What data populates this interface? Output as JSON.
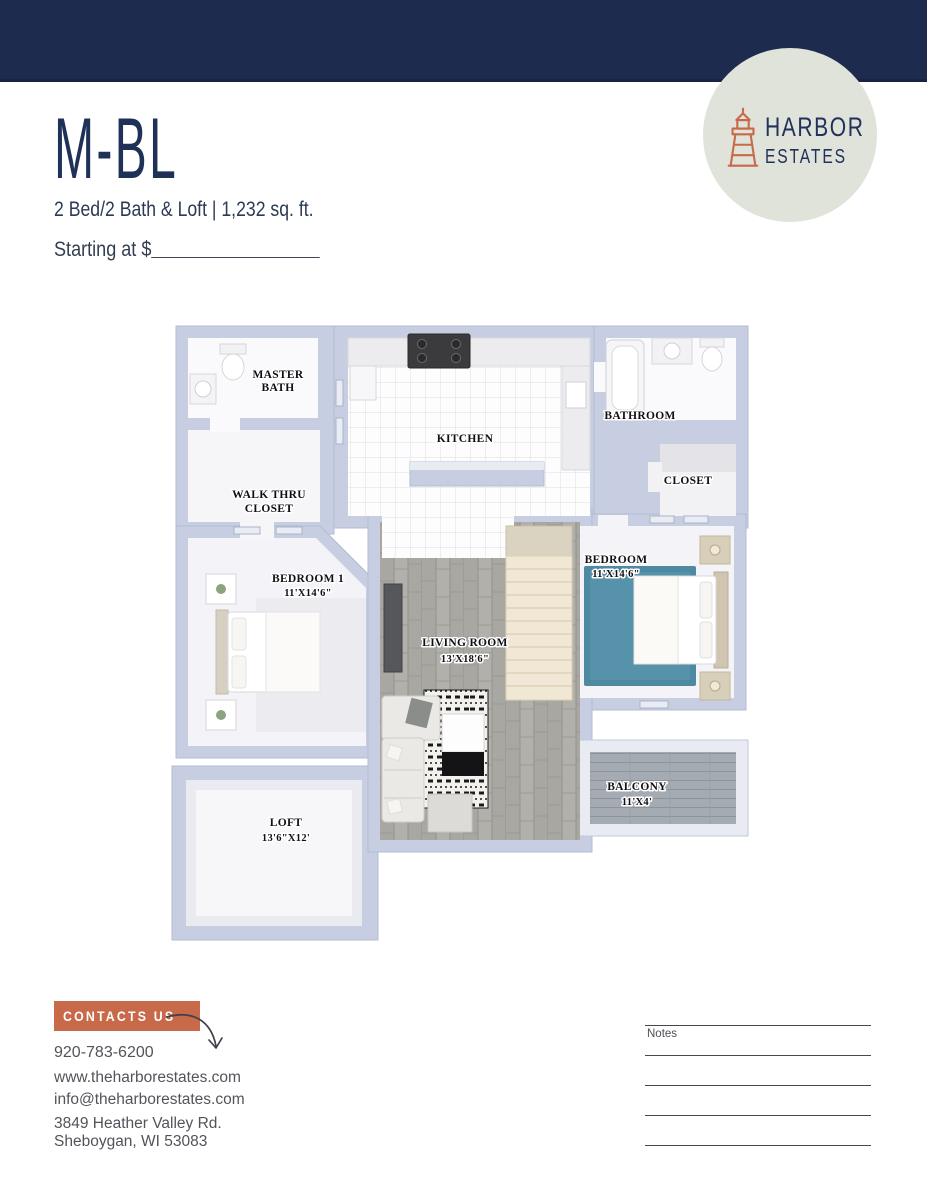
{
  "colors": {
    "header_navy": "#1d2b4e",
    "brand_navy": "#1f3156",
    "accent_orange": "#c8694a",
    "logo_circle_sage": "#dfe3da",
    "wall_gray_blue": "#c7cee1",
    "bedroom_rug_teal": "#4d89a1"
  },
  "logo": {
    "icon": "lighthouse-icon",
    "name_line1": "HARBOR",
    "name_line2": "ESTATES"
  },
  "plan": {
    "title": "M-BL",
    "subtitle": "2 Bed/2 Bath & Loft | 1,232 sq. ft.",
    "starting_at_label": "Starting at $"
  },
  "floorplan": {
    "rooms": [
      {
        "id": "master-bath",
        "line1": "MASTER",
        "line2": "BATH"
      },
      {
        "id": "walk-thru-closet",
        "line1": "WALK THRU",
        "line2": "CLOSET"
      },
      {
        "id": "bedroom-1",
        "line1": "BEDROOM 1",
        "line2": "11'X14'6\""
      },
      {
        "id": "kitchen",
        "line1": "KITCHEN",
        "line2": ""
      },
      {
        "id": "bathroom",
        "line1": "BATHROOM",
        "line2": ""
      },
      {
        "id": "closet",
        "line1": "CLOSET",
        "line2": ""
      },
      {
        "id": "bedroom-2",
        "line1": "BEDROOM",
        "line2": "11'X14'6\""
      },
      {
        "id": "living-room",
        "line1": "LIVING ROOM",
        "line2": "13'X18'6\""
      },
      {
        "id": "balcony",
        "line1": "BALCONY",
        "line2": "11'X4'"
      },
      {
        "id": "loft",
        "line1": "LOFT",
        "line2": "13'6\"X12'"
      }
    ]
  },
  "contact": {
    "button_label": "CONTACTS US",
    "arrow_icon": "curved-arrow-icon",
    "phone": "920-783-6200",
    "website": "www.theharborestates.com",
    "email": "info@theharborestates.com",
    "address_line1": "3849 Heather Valley Rd.",
    "address_line2": "Sheboygan, WI 53083"
  },
  "notes": {
    "label": "Notes",
    "line_count": 5
  }
}
